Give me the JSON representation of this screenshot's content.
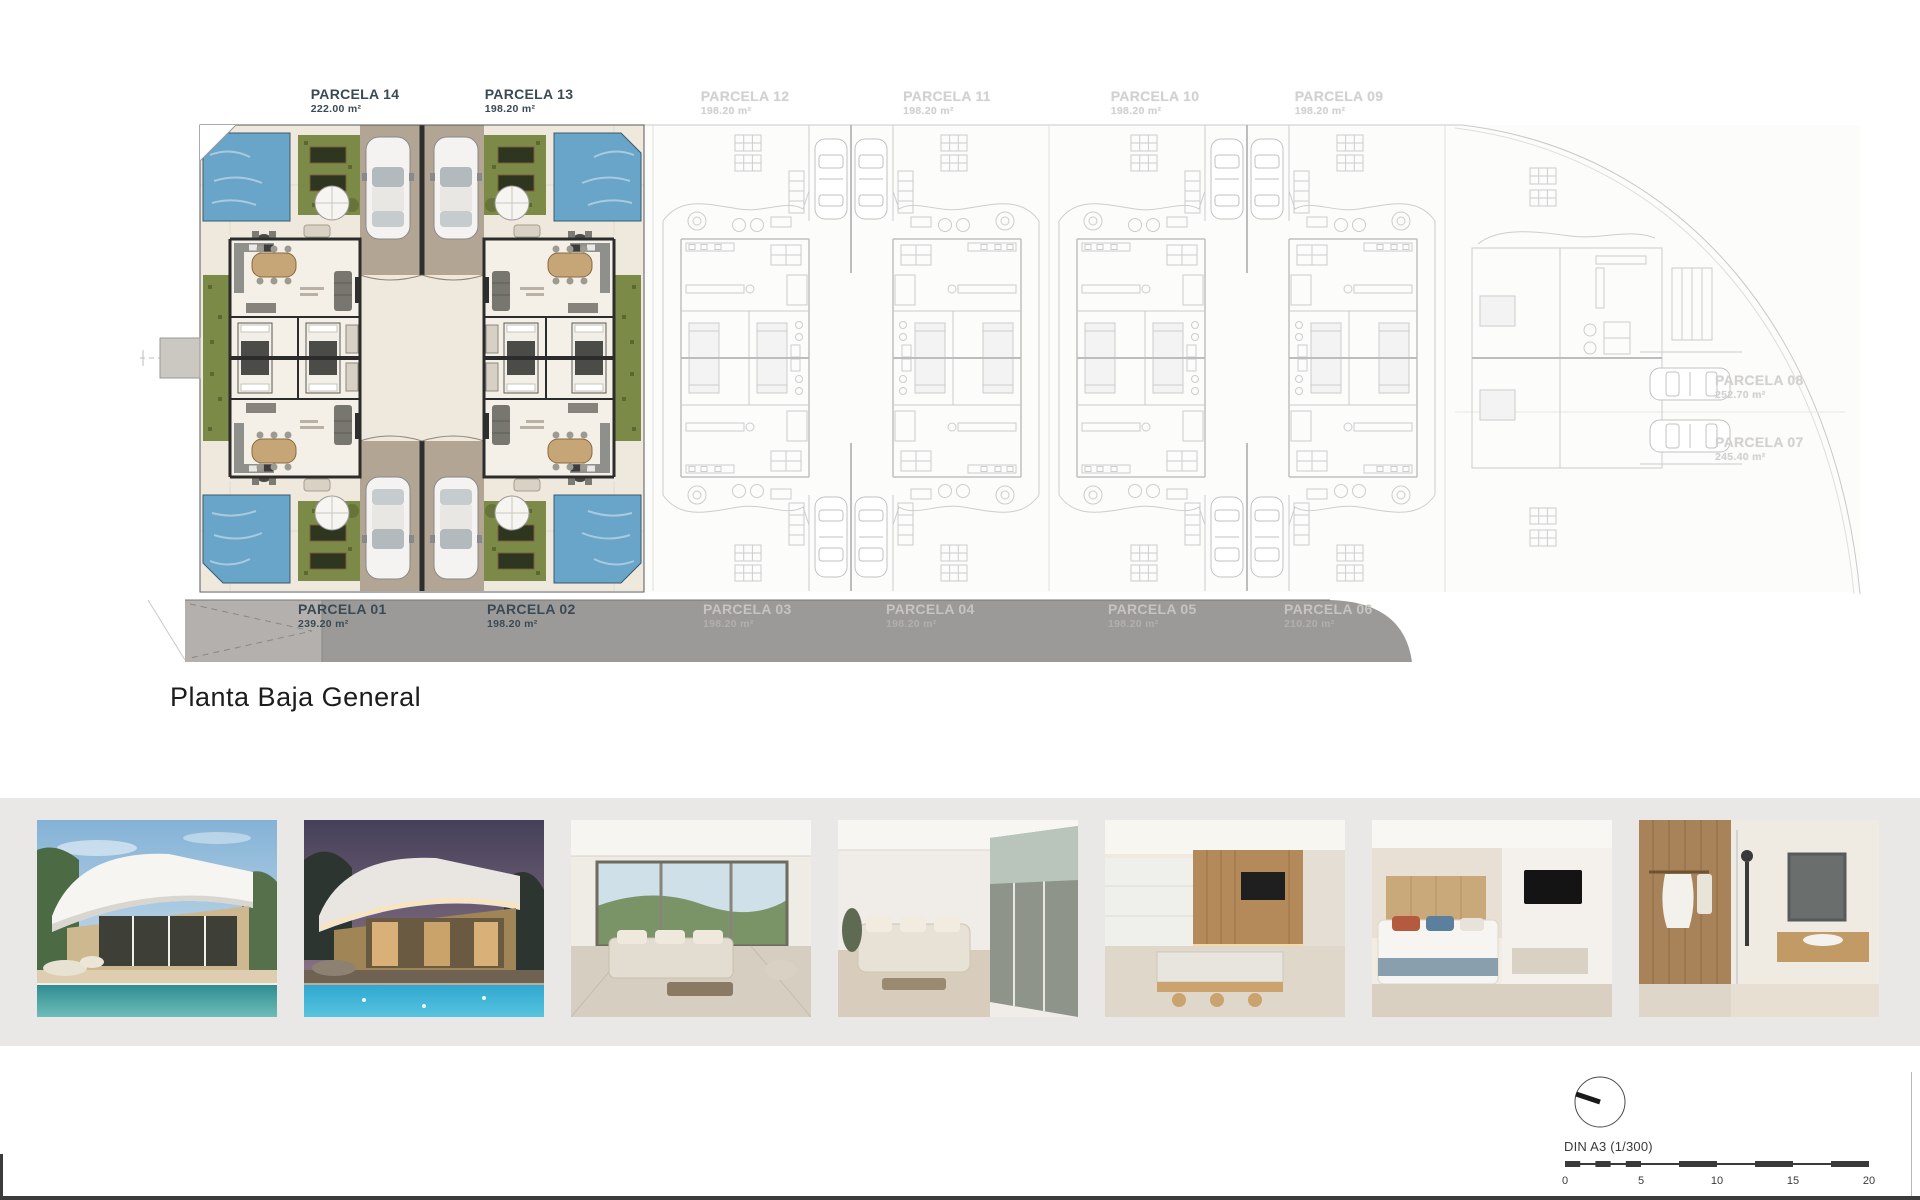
{
  "page": {
    "title_label": "Planta Baja General"
  },
  "site_plan": {
    "top_labels": [
      {
        "name": "PARCELA 14",
        "area": "222.00 m²",
        "style": "dark"
      },
      {
        "name": "PARCELA 13",
        "area": "198.20 m²",
        "style": "dark"
      },
      {
        "name": "PARCELA 12",
        "area": "198.20 m²",
        "style": "faint"
      },
      {
        "name": "PARCELA 11",
        "area": "198.20 m²",
        "style": "faint"
      },
      {
        "name": "PARCELA 10",
        "area": "198.20 m²",
        "style": "faint"
      },
      {
        "name": "PARCELA 09",
        "area": "198.20 m²",
        "style": "faint"
      }
    ],
    "right_labels": [
      {
        "name": "PARCELA 08",
        "area": "252.70 m²"
      },
      {
        "name": "PARCELA 07",
        "area": "245.40 m²"
      }
    ],
    "road_labels": [
      {
        "name": "PARCELA 01",
        "area": "239.20 m²",
        "style": "dark"
      },
      {
        "name": "PARCELA 02",
        "area": "198.20 m²",
        "style": "dark"
      },
      {
        "name": "PARCELA 03",
        "area": "198.20 m²",
        "style": "light"
      },
      {
        "name": "PARCELA 04",
        "area": "198.20 m²",
        "style": "light"
      },
      {
        "name": "PARCELA 05",
        "area": "198.20 m²",
        "style": "light"
      },
      {
        "name": "PARCELA 06",
        "area": "210.20 m²",
        "style": "light"
      }
    ]
  },
  "gallery": {
    "photos": [
      {
        "name": "villa-exterior-day-pool"
      },
      {
        "name": "villa-exterior-dusk-pool"
      },
      {
        "name": "interior-living-terrace-view"
      },
      {
        "name": "interior-living-room"
      },
      {
        "name": "interior-kitchen-dining"
      },
      {
        "name": "interior-bedroom"
      },
      {
        "name": "interior-bathroom"
      }
    ]
  },
  "scale_info": {
    "label": "DIN A3 (1/300)",
    "ticks": [
      "0",
      "5",
      "10",
      "15",
      "20"
    ]
  },
  "colors": {
    "label_dark": "#3a4a54",
    "label_faint": "#d2d1d0",
    "road_gray": "#9c9a99",
    "pool_blue": "#68a5c8",
    "grass_green": "#7c8a47",
    "gallery_band": "#eae8e7"
  }
}
